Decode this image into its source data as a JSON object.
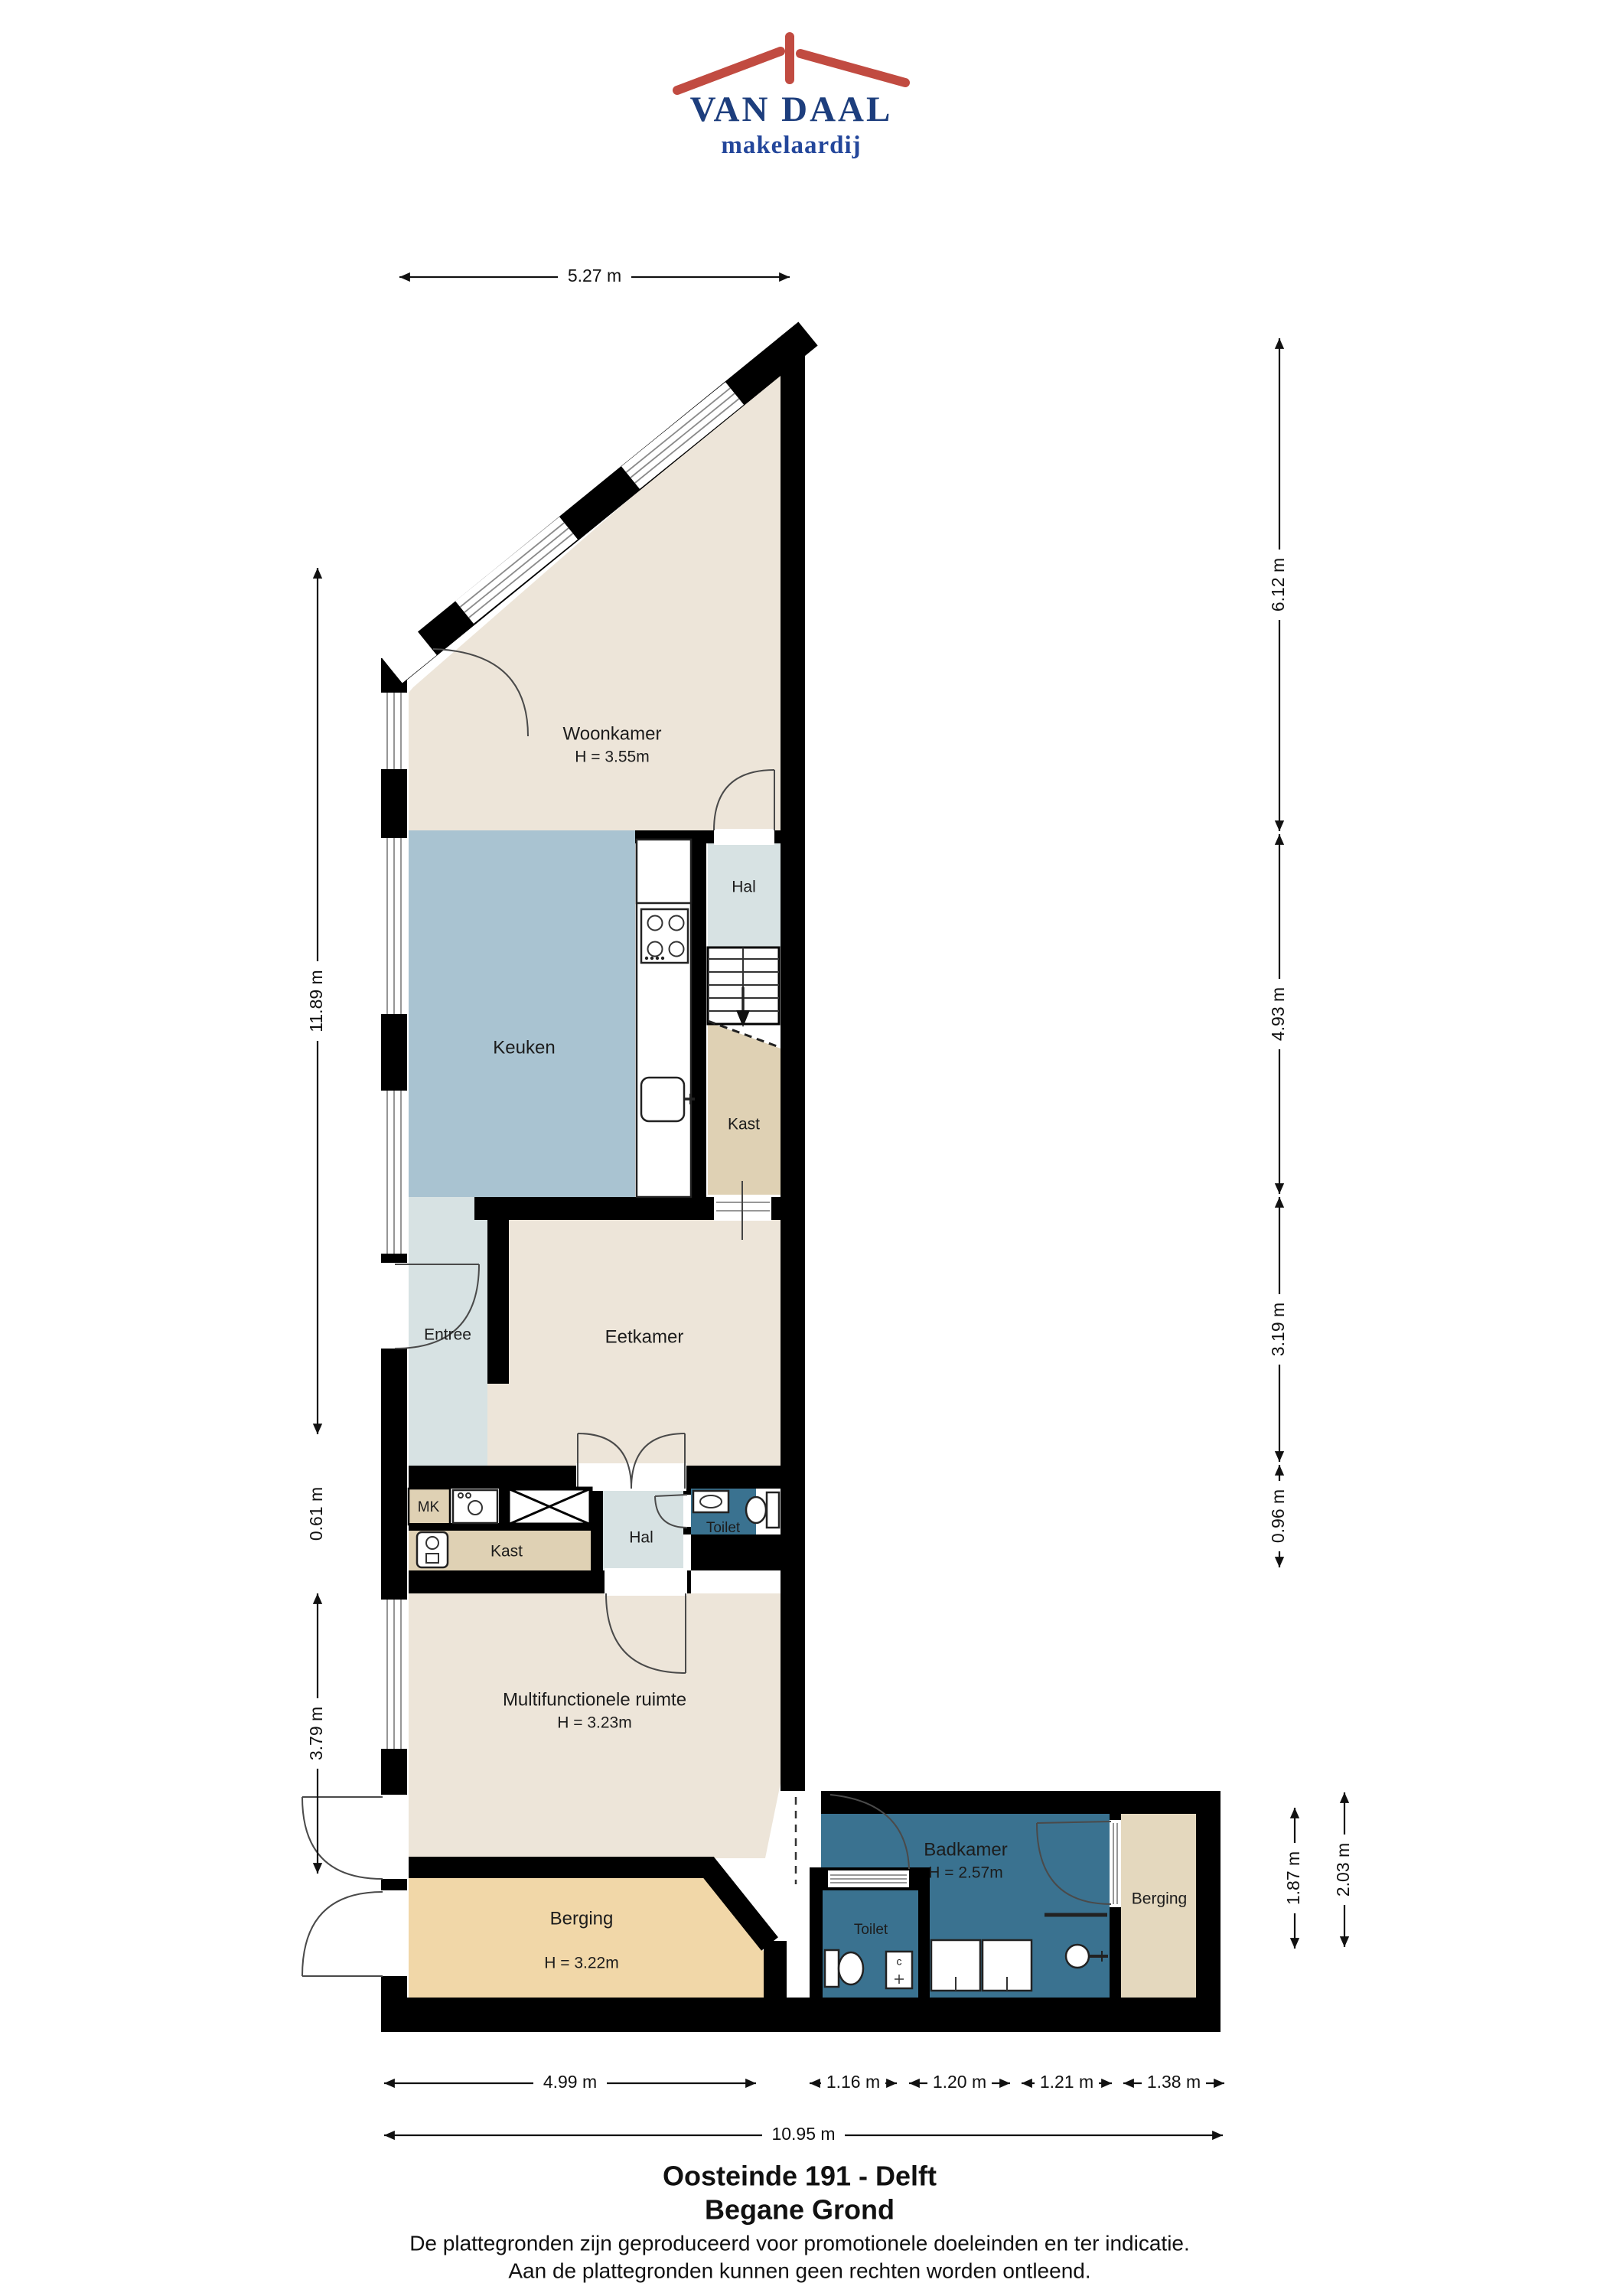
{
  "logo": {
    "name": "VAN DAAL",
    "tagline": "makelaardij"
  },
  "rooms": {
    "woonkamer": {
      "label": "Woonkamer",
      "height": "H = 3.55m"
    },
    "keuken": {
      "label": "Keuken"
    },
    "hal_boven": {
      "label": "Hal"
    },
    "kast_boven": {
      "label": "Kast"
    },
    "entree": {
      "label": "Entree"
    },
    "eetkamer": {
      "label": "Eetkamer"
    },
    "mk": {
      "label": "MK"
    },
    "kast_onder": {
      "label": "Kast"
    },
    "hal_onder": {
      "label": "Hal"
    },
    "toilet_boven": {
      "label": "Toilet"
    },
    "multifunctionele_ruimte": {
      "label": "Multifunctionele ruimte",
      "height": "H = 3.23m"
    },
    "berging_links": {
      "label": "Berging",
      "height": "H = 3.22m"
    },
    "toilet_onder": {
      "label": "Toilet"
    },
    "badkamer": {
      "label": "Badkamer",
      "height": "H = 2.57m"
    },
    "berging_rechts": {
      "label": "Berging"
    }
  },
  "fixtures": {
    "cabinet_label": "c"
  },
  "dimensions": {
    "top_width": "5.27 m",
    "left_height_main": "11.89 m",
    "left_height_small": "0.61 m",
    "left_height_lower": "3.79 m",
    "right_top": "6.12 m",
    "right_mid": "4.93 m",
    "right_lower": "3.19 m",
    "right_small": "0.96 m",
    "wing_inner": "1.87 m",
    "wing_outer": "2.03 m",
    "bottom_left": "4.99 m",
    "bottom_seg1": "1.16 m",
    "bottom_seg2": "1.20 m",
    "bottom_seg3": "1.21 m",
    "bottom_seg4": "1.38 m",
    "bottom_total": "10.95 m"
  },
  "title": {
    "line1": "Oosteinde 191 - Delft",
    "line2": "Begane Grond"
  },
  "footer": {
    "line1": "De plattegronden zijn geproduceerd voor promotionele doeleinden en ter indicatie.",
    "line2": "Aan de plattegronden kunnen geen rechten worden ontleend."
  },
  "colors": {
    "floor_beige": "#EDE5D9",
    "floor_kitchen_blue": "#A9C3D1",
    "floor_light": "#D7E2E3",
    "floor_tan": "#DFD1B4",
    "floor_berging_left": "#F1D7A8",
    "floor_berging_right": "#E4D8BE",
    "floor_dark_blue": "#3A7290",
    "wall_black": "#000000",
    "logo_navy": "#1D3E7D",
    "logo_red": "#C14B41"
  }
}
